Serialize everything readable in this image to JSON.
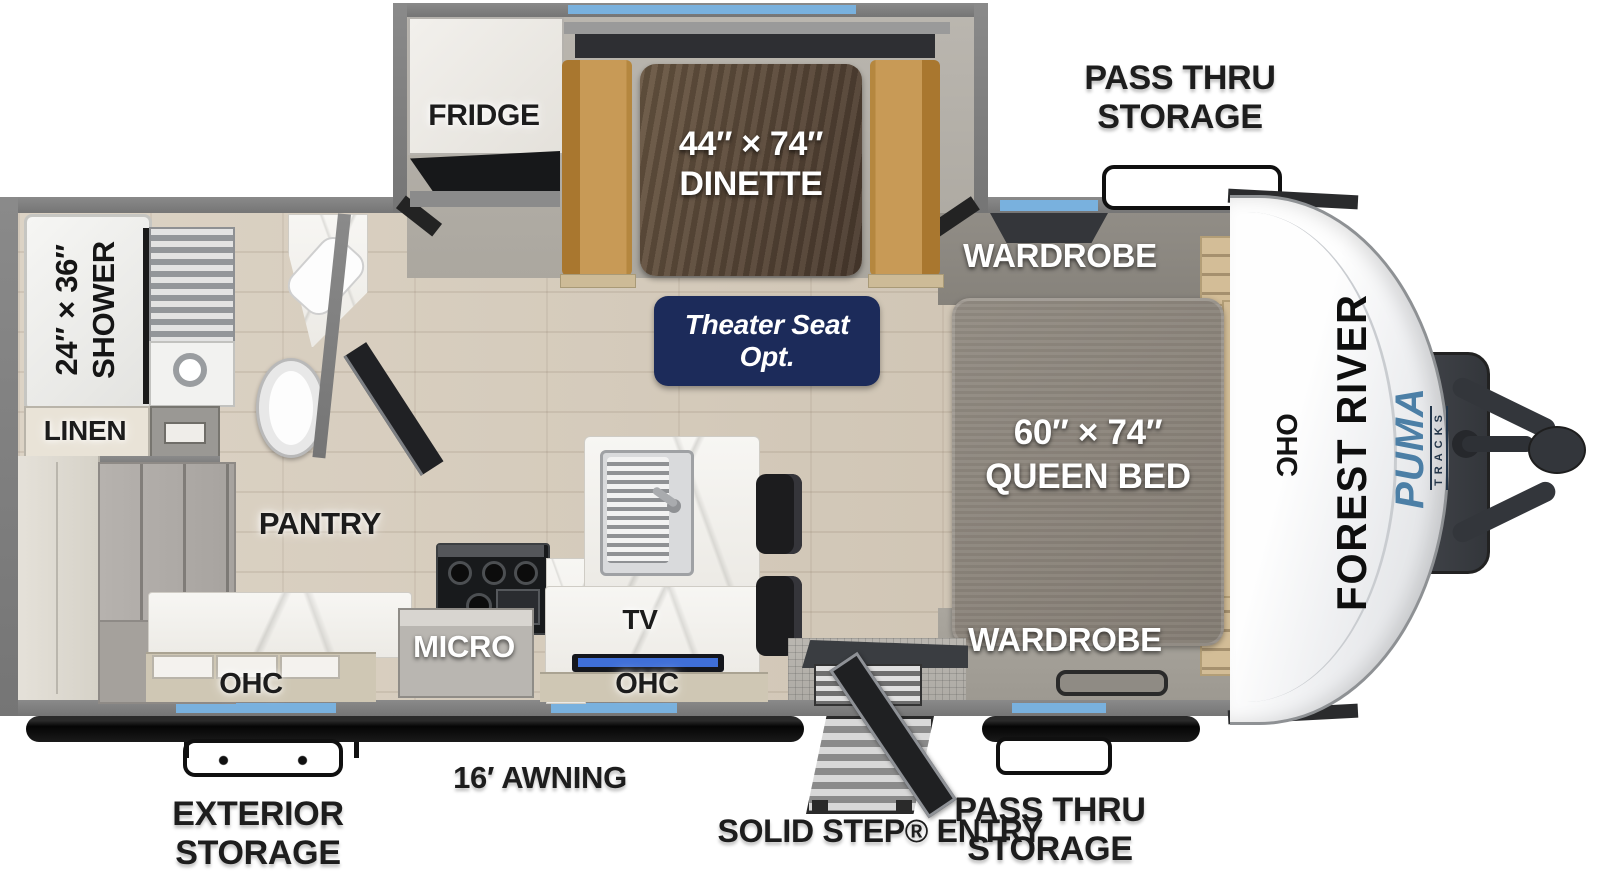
{
  "meta": {
    "title": "Forest River Puma Tracks travel trailer floor plan"
  },
  "branding": {
    "manufacturer": "FOREST RIVER",
    "model": "PUMA",
    "series": "TRACKS"
  },
  "exterior": {
    "pass_thru_top": {
      "line1": "PASS THRU",
      "line2": "STORAGE"
    },
    "pass_thru_bottom": {
      "line1": "PASS THRU",
      "line2": "STORAGE"
    },
    "exterior_storage": {
      "line1": "EXTERIOR",
      "line2": "STORAGE"
    },
    "awning": "16′ AWNING",
    "entry": "SOLID STEP® ENTRY"
  },
  "rooms": {
    "fridge": "FRIDGE",
    "dinette": {
      "size": "44″ × 74″",
      "name": "DINETTE"
    },
    "theater_seat": {
      "line1": "Theater Seat",
      "line2": "Opt."
    },
    "wardrobe_top": "WARDROBE",
    "wardrobe_bottom": "WARDROBE",
    "queen_bed": {
      "size": "60″ × 74″",
      "name": "QUEEN BED"
    },
    "ohc_front": "OHC",
    "shower": {
      "size": "24″ × 36″",
      "name": "SHOWER"
    },
    "linen": "LINEN",
    "pantry": "PANTRY",
    "micro": "MICRO",
    "tv": "TV",
    "ohc_kitchen_left": "OHC",
    "ohc_kitchen_right": "OHC"
  },
  "colors": {
    "window_blue": "#79b1de",
    "badge_navy": "#1c2b5a",
    "bench_tan": "#c89a56",
    "wall_gray": "#7e7e7e",
    "brand_blue": "#4c7fa6",
    "tv_blue": "#3f6fd8"
  }
}
